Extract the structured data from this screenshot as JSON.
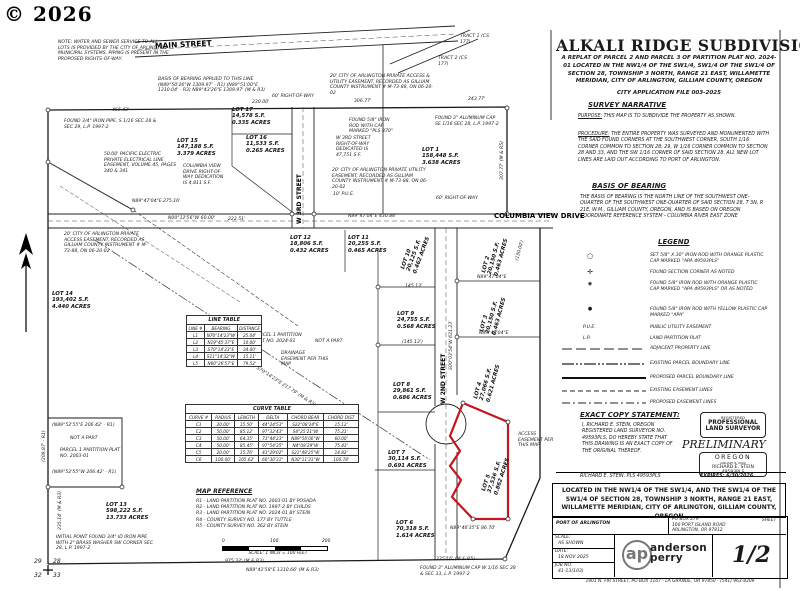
{
  "watermark": "© 2026",
  "header": {
    "title": "ALKALI RIDGE SUBDIVISION",
    "subtitle": "A REPLAT OF PARCEL 2 AND PARCEL 3 OF PARTITION PLAT NO. 2024-01 LOCATED IN THE NW1/4 OF THE SW1/4, SW1/4 OF THE SW1/4 OF SECTION 28, TOWNSHIP 3 NORTH, RANGE 21 EAST, WILLAMETTE MERIDIAN, CITY OF ARLINGTON, GILLIAM COUNTY, OREGON",
    "application": "CITY APPLICATION FILE 003-2025"
  },
  "narrative": {
    "heading": "SURVEY NARRATIVE",
    "purpose_label": "PURPOSE:",
    "purpose": "THIS MAP IS TO SUBDIVIDE THE PROPERTY AS SHOWN.",
    "procedure_label": "PROCEDURE:",
    "procedure": "THE ENTIRE PROPERTY WAS SURVEYED AND MONUMENTED WITH THE SAID FOUND CORNERS AT THE SOUTHWEST CORNER, SOUTH 1/16 CORNER COMMON TO SECTION 28, 29, W 1/16 CORNER COMMON TO SECTION 28 AND 33, AND THE SW 1/16 CORNER OF SAID SECTION 28. ALL NEW LOT LINES ARE LAID OUT ACCORDING TO PORT OF ARLINGTON."
  },
  "basis": {
    "heading": "BASIS OF BEARING",
    "text": "THE BASIS OF BEARING IS THE NORTH LINE OF THE SOUTHWEST ONE-QUARTER OF THE SOUTHWEST ONE-QUARTER OF SAID SECTION 28, T 3N, R 21E, W.M., GILLIAM COUNTY, OREGON, AND IS BASED ON OREGON COORDINATE REFERENCE SYSTEM - COLUMBIA RIVER EAST ZONE"
  },
  "legend": {
    "heading": "LEGEND",
    "symbols": [
      {
        "symbol": "○",
        "text": "SET 5/8\" X 30\" IRON ROD WITH ORANGE PLASTIC CAP MARKED \"APA 49593PLS\""
      },
      {
        "symbol": "✛",
        "text": "FOUND SECTION CORNER AS NOTED"
      },
      {
        "symbol": "◉",
        "text": "FOUND 5/8\" IRON ROD WITH ORANGE PLASTIC CAP MARKED \"APA 49593PLS\" OR AS NOTED"
      },
      {
        "symbol": "●",
        "text": "FOUND 5/8\" IRON ROD WITH YELLOW PLASTIC CAP MARKED \"APA\""
      },
      {
        "symbol": "P.U.E.",
        "text": "PUBLIC UTILITY EASEMENT"
      },
      {
        "symbol": "L.P.",
        "text": "LAND PARTITION PLAT"
      }
    ],
    "lines": [
      {
        "text": "ADJACENT PROPERTY LINE"
      },
      {
        "text": "EXISTING PARCEL BOUNDARY LINE"
      },
      {
        "text": "PROPOSED PARCEL BOUNDARY LINE"
      },
      {
        "text": "EXISTING EASEMENT LINES"
      },
      {
        "text": "PROPOSED EASEMENT LINES"
      }
    ]
  },
  "exact_copy": {
    "heading": "EXACT COPY STATEMENT:",
    "text": "I, RICHARD E. STEIN, OREGON REGISTERED LAND SURVEYOR NO. 49593PLS, DO HEREBY STATE THAT THIS DRAWING IS AN EXACT COPY OF THE ORIGINAL THEREOF.",
    "signature": "RICHARD E. STEIN, PLS 49593PLS",
    "expires": "EXPIRES: 6/30/2026"
  },
  "stamp": {
    "registered": "REGISTERED",
    "professional": "PROFESSIONAL",
    "land_surveyor": "LAND SURVEYOR",
    "preliminary": "PRELIMINARY",
    "state": "OREGON",
    "date": "JANUARY 8, 2000",
    "name": "RICHARD E. STEIN",
    "number": "49593PLS"
  },
  "located_block": "LOCATED IN THE NW1/4 OF THE SW1/4, AND THE SW1/4 OF THE SW1/4 OF SECTION 28, TOWNSHIP 3 NORTH, RANGE 21 EAST, WILLAMETTE MERIDIAN, CITY OF ARLINGTON, GILLIAM COUNTY, OREGON",
  "title_block": {
    "client": "PORT OF ARLINGTON",
    "address_lines": [
      "PO BOX 279",
      "100 PORT ISLAND ROAD",
      "ARLINGTON, OR 97812"
    ],
    "scale_label": "SCALE:",
    "scale": "AS SHOWN",
    "date_label": "DATE:",
    "date": "18 NOV 2025",
    "job_label": "JOB NO.",
    "job": "41-13(103)",
    "sheet_label": "SHEET",
    "sheet": "1/2",
    "logo_abbr": "ap",
    "logo_name1": "anderson",
    "logo_name2": "perry",
    "footer": "1901 N. FIR STREET, PO BOX 1107 - LA GRANDE, OR 97850 - (541) 963-8309"
  },
  "map": {
    "accent_red": "#c4161c",
    "streets": {
      "main": "MAIN STREET",
      "third": "W 3RD STREET",
      "second": "W 2ND STREET",
      "columbia": "COLUMBIA VIEW DRIVE"
    },
    "lots": [
      {
        "lines": [
          "LOT 1",
          "158,448 S.F.",
          "3.638 ACRES"
        ]
      },
      {
        "lines": [
          "LOT 2",
          "20,150 S.F.",
          "0.463 ACRES"
        ]
      },
      {
        "lines": [
          "LOT 3",
          "20,150 S.F.",
          "0.463 ACRES"
        ]
      },
      {
        "lines": [
          "LOT 4",
          "27,066 S.F.",
          "0.621 ACRES"
        ]
      },
      {
        "lines": [
          "LOT 5",
          "37,536 S.F.",
          "0.862 ACRES"
        ]
      },
      {
        "lines": [
          "LOT 6",
          "70,318 S.F.",
          "1.614 ACRES"
        ]
      },
      {
        "lines": [
          "LOT 7",
          "30,114 S.F.",
          "0.691 ACRES"
        ]
      },
      {
        "lines": [
          "LOT 8",
          "29,861 S.F.",
          "0.686 ACRES"
        ]
      },
      {
        "lines": [
          "LOT 9",
          "24,755 S.F.",
          "0.568 ACRES"
        ]
      },
      {
        "lines": [
          "LOT 10",
          "20,125 S.F.",
          "0.462 ACRES"
        ]
      },
      {
        "lines": [
          "LOT 11",
          "20,255 S.F.",
          "0.465 ACRES"
        ]
      },
      {
        "lines": [
          "LOT 12",
          "18,806 S.F.",
          "0.432 ACRES"
        ]
      },
      {
        "lines": [
          "LOT 13",
          "598,222 S.F.",
          "13.733 ACRES"
        ]
      },
      {
        "lines": [
          "LOT 14",
          "193,402 S.F.",
          "4.440 ACRES"
        ]
      },
      {
        "lines": [
          "LOT 15",
          "147,188 S.F.",
          "3.379 ACRES"
        ]
      },
      {
        "lines": [
          "LOT 16",
          "11,533 S.F.",
          "0.265 ACRES"
        ]
      },
      {
        "lines": [
          "LOT 17",
          "14,578 S.F.",
          "0.335 ACRES"
        ]
      }
    ],
    "notes": [
      "NOTE: WATER AND SEWER SERVICE TO ALL LOTS IS PROVIDED BY THE CITY OF ARLINGTON MUNICIPAL SYSTEMS.  PIPING IS PRESENT IN THE PROPOSED RIGHTS-OF-WAY.",
      "BASIS OF BEARING APPLIED TO THIS LINE (N89°50'26\"W 1309.97' - R1) (N89°51'00\"E 1310.04' - R3) N89°43'26\"E 1309.97' (M & R3)",
      "FOUND 3/4\" IRON PIPE, S 1/16 SEC 28 & SEC 29, L.P. 1997-2",
      "50.00' PACIFIC ELECTRIC PRIVATE ELECTRICAL LINE EASEMENT, VOLUME 45, PAGES 340 & 341",
      "COLUMBIA VIEW DRIVE RIGHT-OF-WAY DEDICATION IS 4,811 S.F.",
      "20' CITY OF ARLINGTON PRIVATE ACCESS EASEMENT, RECORDED AS GILLIAM COUNTY INSTRUMENT # M-73-88, ON 06-20-02",
      "20' CITY OF ARLINGTON PRIVATE ACCESS & UTILITY EASEMENT, RECORDED AS GILLIAM COUNTY INSTRUMENT # M-73-88, ON 06-20-02",
      "FOUND 5/8\" IRON ROD WITH CAP MARKED \"PLS 870\"",
      "W 3RD STREET RIGHT-OF-WAY DEDICATED IS 47,751 S.F.",
      "20' CITY OF ARLINGTON PRIVATE UTILITY EASEMENT, RECORDED AS GILLIAM COUNTY INSTRUMENT # M-73-88, ON 06-20-02",
      "FOUND 3\" ALUMINUM CAP SE 1/16 SEC 28, L.P. 1997-2",
      "ACCESS EASEMENT PER THIS MAP",
      "DRAINAGE EASEMENT PER THIS MAP",
      "NOT A PART",
      "PARCEL 1 PARTITION PLAT NO. 2024-01",
      "NOT A PART",
      "PARCEL 1 PARTITION PLAT NO. 2003-01",
      "INITIAL POINT FOUND 3/4\" ID IRON PIPE WITH 2\" BRASS WASHER SW CORNER SEC 28, L.P. 1997-2",
      "FOUND 3\" ALUMINUM CAP W 1/16 SEC 28 & SEC 33, L.P. 1997-2",
      "TRACT 2 (CS 177)",
      "TRACT 1 (CS 177)"
    ],
    "dims": [
      "466.43'",
      "243.77'",
      "230.00'",
      "306.77'",
      "N89°47'04\"E  275.16'",
      "N00°12'56\"W  60.00'",
      "60' RIGHT-OF-WAY",
      "60' RIGHT-OF-WAY",
      "10' P.U.E.",
      "N89°47'04\"E  430.84'",
      "222.51'",
      "145.13'",
      "(145.13')",
      "S00°03'54\"W 631.23'",
      "N89°46'35\"E  86.70'",
      "335.16' (M & R5)",
      "975.32' (M & R3)",
      "N89°41'58\"E  1310.66' (M & R3)",
      "(N89°52'55\"E 206.42' - R1)",
      "(N89°52'55\"W 206.42' - R1)",
      "S70°14'23\"E  217.79' (M & R3)",
      "(209.87' - R1)",
      "235.14' (M & R3)",
      "307.77' (M & R5)",
      "N89°47'04\"E",
      "N89°47'04\"E",
      "(130.00')"
    ],
    "line_table": {
      "title": "LINE TABLE",
      "header": [
        [
          "LINE #",
          "BEARING",
          "DISTANCE"
        ]
      ],
      "rows": [
        [
          "L1",
          "N70°14'23\"W",
          "25.04'"
        ],
        [
          "L2",
          "N19°45'37\"E",
          "10.00'"
        ],
        [
          "L3",
          "S70°14'23\"E",
          "34.00'"
        ],
        [
          "L4",
          "S11°14'32\"W",
          "15.11'"
        ],
        [
          "L5",
          "N60°26'57\"E",
          "79.52'"
        ]
      ]
    },
    "curve_table": {
      "title": "CURVE TABLE",
      "header": [
        [
          "CURVE #",
          "RADIUS",
          "LENGTH",
          "DELTA",
          "CHORD BEAR",
          "CHORD DIST"
        ]
      ],
      "rows": [
        [
          "C1",
          "20.00'",
          "15.50'",
          "44°24'53\"",
          "S22°08'24\"E",
          "15.12'"
        ],
        [
          "C2",
          "50.00'",
          "85.12'",
          "97°32'43\"",
          "S4°25'21\"W",
          "75.21'"
        ],
        [
          "C3",
          "50.00'",
          "64.35'",
          "73°44'23\"",
          "N89°56'06\"W",
          "60.00'"
        ],
        [
          "C4",
          "50.00'",
          "85.45'",
          "97°54'35\"",
          "N4°08'29\"W",
          "75.43'"
        ],
        [
          "C5",
          "20.00'",
          "15.76'",
          "43°29'02\"",
          "S21°48'25\"W",
          "14.82'"
        ],
        [
          "C6",
          "100.00'",
          "105.62'",
          "60°30'31\"",
          "N30°11'31\"W",
          "100.78'"
        ]
      ]
    },
    "map_reference": {
      "heading": "MAP REFERENCE",
      "items": [
        "R1 - LAND PARTITION PLAT NO. 2003-01 BY POSADA",
        "R2 - LAND PARTITION PLAT NO. 1997-2 BY CHILDS",
        "R3 - LAND PARTITION PLAT NO. 2024-01 BY STEIN",
        "R4 - COUNTY SURVEY NO. 177 BY TUTTLE",
        "R5 - COUNTY SURVEY NO. 362 BY STEIN"
      ],
      "ticks": [
        "0",
        "100",
        "200"
      ],
      "scale_text": "SCALE: 1 INCH = 100 FEET"
    },
    "section_corner": {
      "nw": "29",
      "ne": "28",
      "sw": "32",
      "se": "33"
    }
  }
}
